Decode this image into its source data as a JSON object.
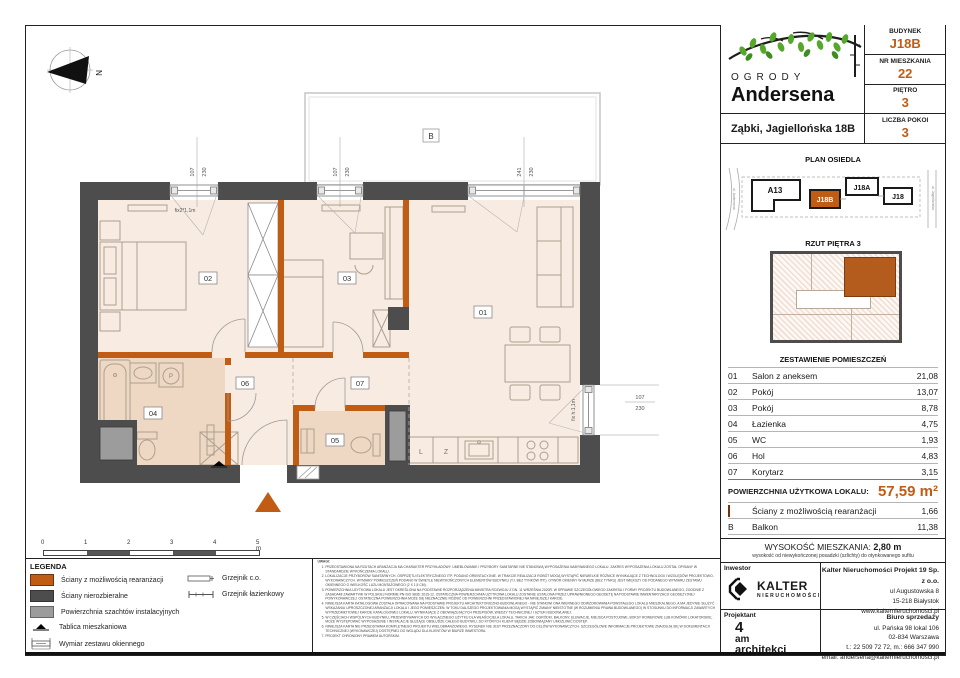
{
  "header": {
    "logo_line1": "OGRODY",
    "logo_line2": "Andersena",
    "address": "Ząbki, Jagiellońska 18B",
    "fields": [
      {
        "label": "BUDYNEK",
        "value": "J18B"
      },
      {
        "label": "NR MIESZKANIA",
        "value": "22"
      },
      {
        "label": "PIĘTRO",
        "value": "3"
      },
      {
        "label": "LICZBA POKOI",
        "value": "3"
      }
    ]
  },
  "site_plan": {
    "title": "PLAN OSIEDLA",
    "buildings": [
      {
        "label": "A13",
        "highlight": false
      },
      {
        "label": "J18B",
        "highlight": true
      },
      {
        "label": "J18A",
        "highlight": false
      },
      {
        "label": "J18",
        "highlight": false
      }
    ],
    "street_left": "ul. Andersena",
    "street_right": "ul. Jagiellońska"
  },
  "floor_thumb": {
    "title": "RZUT PIĘTRA 3"
  },
  "rooms": {
    "title": "ZESTAWIENIE POMIESZCZEŃ",
    "rows": [
      {
        "no": "01",
        "name": "Salon z aneksem",
        "area": "21,08"
      },
      {
        "no": "02",
        "name": "Pokój",
        "area": "13,07"
      },
      {
        "no": "03",
        "name": "Pokój",
        "area": "8,78"
      },
      {
        "no": "04",
        "name": "Łazienka",
        "area": "4,75"
      },
      {
        "no": "05",
        "name": "WC",
        "area": "1,93"
      },
      {
        "no": "06",
        "name": "Hol",
        "area": "4,83"
      },
      {
        "no": "07",
        "name": "Korytarz",
        "area": "3,15"
      }
    ],
    "total_label": "POWIERZCHNIA UŻYTKOWA LOKALU:",
    "total_value": "57,59 m²",
    "walls_row": {
      "name": "Ściany z możliwością rearanżacji",
      "area": "1,66"
    },
    "balcony_row": {
      "no": "B",
      "name": "Balkon",
      "area": "11,38"
    }
  },
  "height": {
    "label": "WYSOKOŚĆ MIESZKANIA:",
    "value": "2,80 m",
    "note": "wysokość od niewykończonej posadzki (szlichty) do otynkowanego sufitu"
  },
  "partners": {
    "investor_label": "Inwestor",
    "investor_name": "KALTER",
    "investor_sub": "NIERUCHOMOŚCI",
    "company": "Kalter Nieruchomości Projekt 19 Sp. z o.o.",
    "company_addr1": "ul Augustowska 8",
    "company_addr2": "15-218 Białystok",
    "company_web": "www.kalternieruchomosci.pl",
    "designer_label": "Projektant",
    "designer_1": "4",
    "designer_2": "am",
    "designer_3": "architekci",
    "office_label": "Biuro sprzedaży",
    "office_addr1": "ul. Pańska 98 lokal 106",
    "office_addr2": "02-834 Warszawa",
    "office_phone": "t.: 22 509 72 72, m.: 666 347 990",
    "office_email": "email: andersena@kalternieruchomosci.pl"
  },
  "legend": {
    "title": "LEGENDA",
    "item1": "Ściany z możliwością rearanżacji",
    "item2": "Ściany nierozbieralne",
    "item3": "Powierzchnia szachtów instalacyjnych",
    "item4": "Tablica mieszkaniowa",
    "item5": "Wymiar zestawu okiennego",
    "item6": "Grzejnik c.o.",
    "item7": "Grzejnik łazienkowy"
  },
  "scale_bar": {
    "t0": "0",
    "t1": "1",
    "t2": "2",
    "t3": "3",
    "t4": "4",
    "t5": "5 m"
  },
  "notes": {
    "title": "UWAGI:",
    "items": [
      "PRZEDSTAWIONA NA RZUTACH ARANŻACJA MA CHARAKTER PRZYKŁADOWY. UMEBLOWANIE I PRZYBORY SANITARNE NIE STANOWIĄ WYPOSAŻENIA NABYWANEGO LOKALU. ZAKRES WYPOSAŻENIA LOKALU ZOSTAŁ OPISANY W STANDARDZIE WYKOŃCZENIA LOKALU.",
      "LOKALIZACJE PRZYBORÓW SANITARNYCH, OSPRZĘTU ELEKTRYCZNEGO ITP. PODANO ORIENTACYJNIE. W TRAKCIE REALIZACJI ROBÓT MOGĄ WYSTĄPIĆ NIEWIELKIE RÓŻNICE WYNIKAJĄCE Z TECHNOLOGII I WZGLĘDÓW PROJEKTOWO-WYKONAWCZYCH. WYMIARY POMIESZCZEŃ PODANO W ŚWIETLE NIEWYKOŃCZONYCH ELEMENTÓW BUDYNKU (TJ. BEZ TYNKÓW ITP.). OTWÓR OKIENNY W MURZE (BEZ TYNKU) JEST WIĘKSZY OD PODANEGO WYMIARU ZESTAWU OKIENNEGO O WIELKOŚĆ LUZU MONTAŻOWEGO (2 X 1,5 CM).",
      "POWIERZCHNIA UŻYTKOWA LOKALU JEST OKREŚLONA NA PODSTAWIE ROZPORZĄDZENIA MINISTRA ROZWOJU Z DN. 11 WRZEŚNIA 2020R. W SPRAWIE SZCZEGÓŁOWEGO ZAKRESU I FORMY PROJEKTU BUDOWLANEGO, ZGODNIE Z ZASADAMI ZAWARTYMI W POLSKIEJ NORMIE PN-ISO 9836: 2015-12. OSTATECZNA POWIERZCHNIA UŻYTKOWA LOKALU ZOSTANIE USTALONA PRZEZ UPRAWNIONEGO GEODETĘ NA PODSTAWIE INWENTARYZACJI GEODEZYJNEJ POWYKONAWCZEJ. OSTATECZNA POWIERZCHNIA MOŻE SIĘ NIEZNACZNIE RÓŻNIĆ OD POWIERZCHNI PRZEDSTAWIONEJ NA NINIEJSZEJ KARCIE.",
      "NINIEJSZA KARTA KATALOGOWA ZOSTAŁA OPRACOWANA NA PODSTAWIE PROJEKTU ARCHITEKTONICZNO-BUDOWLANEGO - NIE STANOWI ONA WIERNEGO ODWZOROWANIA POWSTAŁEGO LOKALU MIESZKALNEGO, A MA JEDYNIE SŁUŻYĆ WSKAZANIU UPROSZCZONEJ ARANŻACJI LOKALU I JEGO POMIESZCZEŃ. W TOKU DALSZEGO PROJEKTOWANIA MOGĄ WYSTĄPIĆ ZMIANY NIEISTOTNE (W ROZUMIENIU PRAWA BUDOWLANEGO) W STOSUNKU DO INFORMACJI ZAWARTYCH W PRZEDMIOTOWEJ KARCIE KATALOGOWEJ LOKALU, WYNIKAJĄCE Z OBOWIĄZUJĄCYCH PRZEPISÓW, WIEDZY TECHNICZNEJ I SZTUKI BUDOWLANEJ.",
      "W CZĘŚCIACH WSPÓLNYCH BUDYNKU, PRZEWIDYWANYCH DO WYŁĄCZNEGO UŻYTKU DLA WŁAŚCICIELA LOKALU, TAKICH JAK: OGRÓDKI, BALKONY, ELEWACJE, MIEJSCA POSTOJOWE, BOKSY ROWEROWE LUB KOMÓRKI LOKATORSKIE, MOŻE WYSTĘPOWAĆ WYPOSAŻENIE I INSTALACJE SŁUŻĄCE OBSŁUDZE CAŁEGO BUDYNKU, DO KTÓRYCH KLIENT BĘDZIE ZOBOWIĄZANY UMOŻLIWIĆ DOSTĘP.",
      "NINIEJSZA KARTA NIE PRZEDSTAWIA KOMPLETNEGO PROJEKTU WIELOBRANŻOWEGO. RYSUNEK NIE JEST PRZEZNACZONY DO CELÓW WYKONAWCZYCH. SZCZEGÓŁOWE INFORMACJE PROJEKTOWE ZNAJDUJĄ SIĘ W DOKUMENTACJI TECHNICZNEJ (WYKONAWCZEJ) DOSTĘPNEJ DO WGLĄDU DLA KLIENTÓW W BIURZE INWESTORA.",
      "PROJEKT CHRONIONY PRAWEM AUTORSKIM."
    ]
  },
  "plan": {
    "north": "N",
    "balcony": "B",
    "tags": {
      "t01": "01",
      "t02": "02",
      "t03": "03",
      "t04": "04",
      "t05": "05",
      "t06": "06",
      "t07": "07"
    },
    "dims": {
      "d1a": "107",
      "d1b": "230",
      "d2a": "107",
      "d2b": "230",
      "d3a": "241",
      "d3b": "230",
      "d4a": "107",
      "d4b": "230"
    },
    "fix_top": "fix2*1,1m",
    "fix_right": "fix h:1,1m",
    "washer": "P",
    "fridge": "L",
    "dishwasher": "Z"
  },
  "colors": {
    "accent": "#c05c14",
    "wall": "#4d4d4d",
    "shaft": "#9c9c9c",
    "room_fill": "#f8ece2",
    "bath_fill": "#eed8c3",
    "leaf_green": "#56a82c"
  }
}
